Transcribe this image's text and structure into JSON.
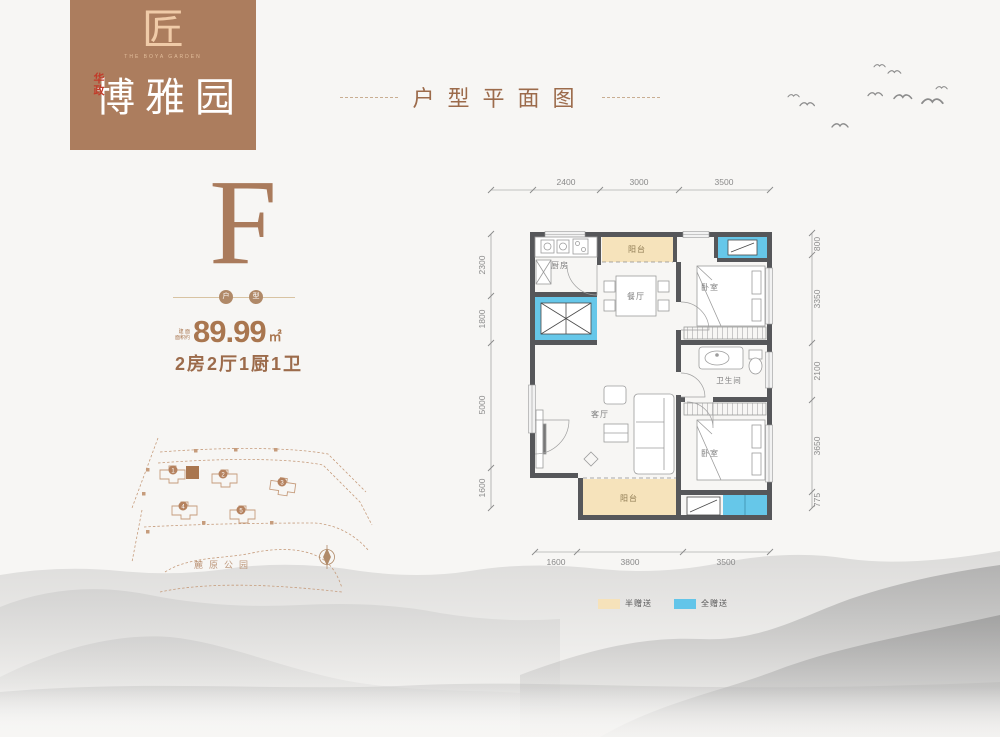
{
  "logo": {
    "mark": "匠",
    "latin": "THE BOYA GARDEN",
    "prefix": "华政",
    "name": "博雅园",
    "bg_color": "#ac7d5e",
    "mark_color": "#f0cba8",
    "prefix_color": "#c23b2a"
  },
  "header": {
    "title": "户型平面图"
  },
  "unit": {
    "letter": "F",
    "badge1": "户",
    "badge2": "型",
    "area_small_1": "建 面",
    "area_small_2": "面积约",
    "area_value": "89.99",
    "area_unit": "㎡",
    "config": "2房2厅1厨1卫"
  },
  "floorplan": {
    "rooms": {
      "kitchen": "厨房",
      "balcony_top": "阳台",
      "dining": "餐厅",
      "bedroom_top": "卧室",
      "bathroom": "卫生间",
      "living": "客厅",
      "bedroom_bottom": "卧室",
      "balcony_bottom": "阳台"
    },
    "dims": {
      "top": [
        "2400",
        "3000",
        "3500"
      ],
      "bottom": [
        "1600",
        "3800",
        "3500"
      ],
      "left": [
        "2300",
        "1800",
        "5000",
        "1600"
      ],
      "right": [
        "800",
        "3350",
        "2100",
        "3650",
        "775"
      ]
    },
    "colors": {
      "wall": "#56575a",
      "half_gift": "#f6e3bb",
      "full_gift": "#66c7e9"
    }
  },
  "legend": [
    {
      "label": "半赠送",
      "color": "#f6e2ba"
    },
    {
      "label": "全赠送",
      "color": "#63c5e9"
    }
  ],
  "sitemap": {
    "park": "麓原公园",
    "buildings": [
      "1",
      "2",
      "3",
      "4",
      "5"
    ]
  }
}
